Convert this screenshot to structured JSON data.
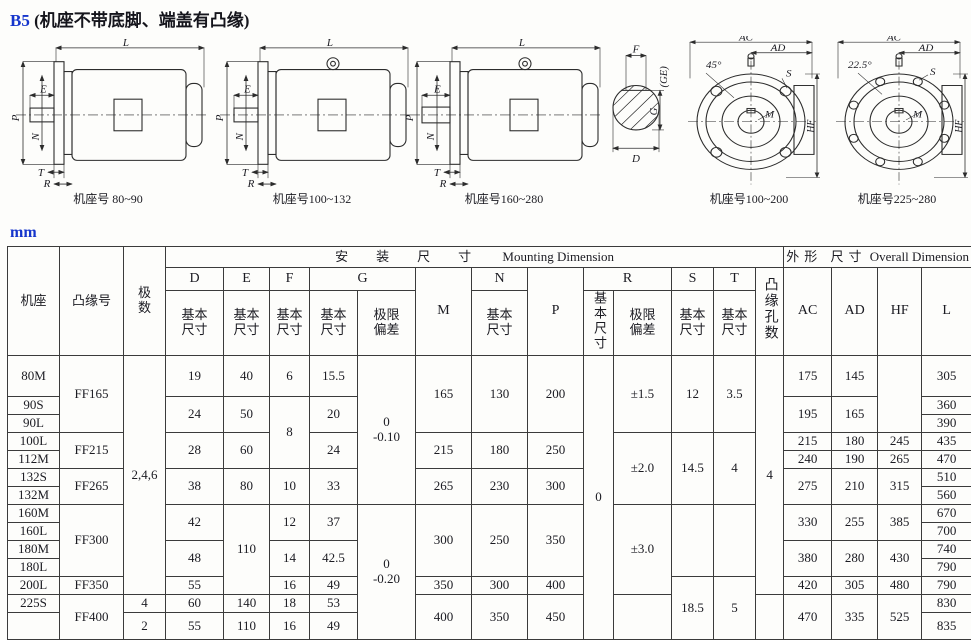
{
  "title": {
    "code": "B5",
    "rest": " (机座不带底脚、端盖有凸缘)"
  },
  "unit_label": "mm",
  "figures": {
    "f1": {
      "caption": "机座号 80~90",
      "L": "L",
      "E": "E",
      "P": "P",
      "N": "N",
      "T": "T",
      "R": "R"
    },
    "f2": {
      "caption": "机座号100~132",
      "L": "L",
      "E": "E",
      "P": "P",
      "N": "N",
      "T": "T",
      "R": "R"
    },
    "f3": {
      "caption": "机座号160~280",
      "L": "L",
      "E": "E",
      "P": "P",
      "N": "N",
      "T": "T",
      "R": "R"
    },
    "f4": {
      "F": "F",
      "GE": "(GE)",
      "G": "G",
      "D": "D"
    },
    "f5": {
      "caption": "机座号100~200",
      "angle": "45°",
      "AC": "AC",
      "AD": "AD",
      "S": "S",
      "M": "M",
      "HF": "HF"
    },
    "f6": {
      "caption": "机座号225~280",
      "angle": "22.5°",
      "AC": "AC",
      "AD": "AD",
      "S": "S",
      "M": "M",
      "HF": "HF"
    }
  },
  "table": {
    "h": {
      "frame": "机座",
      "flange": "凸缘号",
      "poles": "极\n数",
      "mount_cn": "安装尺寸",
      "mount_en": "Mounting Dimension",
      "overall_cn": "外形 尺寸",
      "overall_en": "Overall Dimension",
      "D": "D",
      "E": "E",
      "F": "F",
      "G": "G",
      "M": "M",
      "N": "N",
      "P": "P",
      "R": "R",
      "S": "S",
      "T": "T",
      "basic": "基本\n尺寸",
      "dev": "极限\n偏差",
      "basic_v": "基本尺寸",
      "holes_v": "凸缘孔数",
      "AC": "AC",
      "AD": "AD",
      "HF": "HF",
      "L": "L"
    },
    "rows": {
      "frames": [
        "80M",
        "90S",
        "90L",
        "100L",
        "112M",
        "132S",
        "132M",
        "160M",
        "160L",
        "180M",
        "180L",
        "200L",
        "225S",
        ""
      ],
      "flange": {
        "ff165": "FF165",
        "ff215": "FF215",
        "ff265": "FF265",
        "ff300": "FF300",
        "ff350": "FF350",
        "ff400": "FF400"
      },
      "poles": {
        "main": "2,4,6",
        "p225": "4",
        "plast": "2"
      },
      "D": [
        "19",
        "24",
        "28",
        "38",
        "42",
        "48",
        "55",
        "60",
        "55"
      ],
      "E": [
        "40",
        "50",
        "60",
        "80",
        "110",
        "140",
        "110"
      ],
      "F": [
        "6",
        "8",
        "10",
        "12",
        "14",
        "16",
        "18",
        "16"
      ],
      "G": [
        "15.5",
        "20",
        "24",
        "33",
        "37",
        "42.5",
        "49",
        "53",
        "49"
      ],
      "Gdev": [
        "0\n-0.10",
        "0\n-0.20"
      ],
      "M": [
        "165",
        "215",
        "265",
        "300",
        "350",
        "400"
      ],
      "N": [
        "130",
        "180",
        "230",
        "250",
        "300",
        "350"
      ],
      "P": [
        "200",
        "250",
        "300",
        "350",
        "400",
        "450"
      ],
      "Rbasic": "0",
      "Rdev": [
        "±1.5",
        "±2.0",
        "±3.0"
      ],
      "S": [
        "12",
        "14.5",
        "18.5"
      ],
      "T": [
        "3.5",
        "4",
        "5"
      ],
      "holes": "4",
      "AC": [
        "175",
        "195",
        "215",
        "240",
        "275",
        "330",
        "380",
        "420",
        "470"
      ],
      "AD": [
        "145",
        "165",
        "180",
        "190",
        "210",
        "255",
        "280",
        "305",
        "335"
      ],
      "HF": [
        "245",
        "265",
        "315",
        "385",
        "430",
        "480",
        "525"
      ],
      "L": [
        "305",
        "360",
        "390",
        "435",
        "470",
        "510",
        "560",
        "670",
        "700",
        "740",
        "790",
        "790",
        "830",
        "835"
      ]
    }
  }
}
